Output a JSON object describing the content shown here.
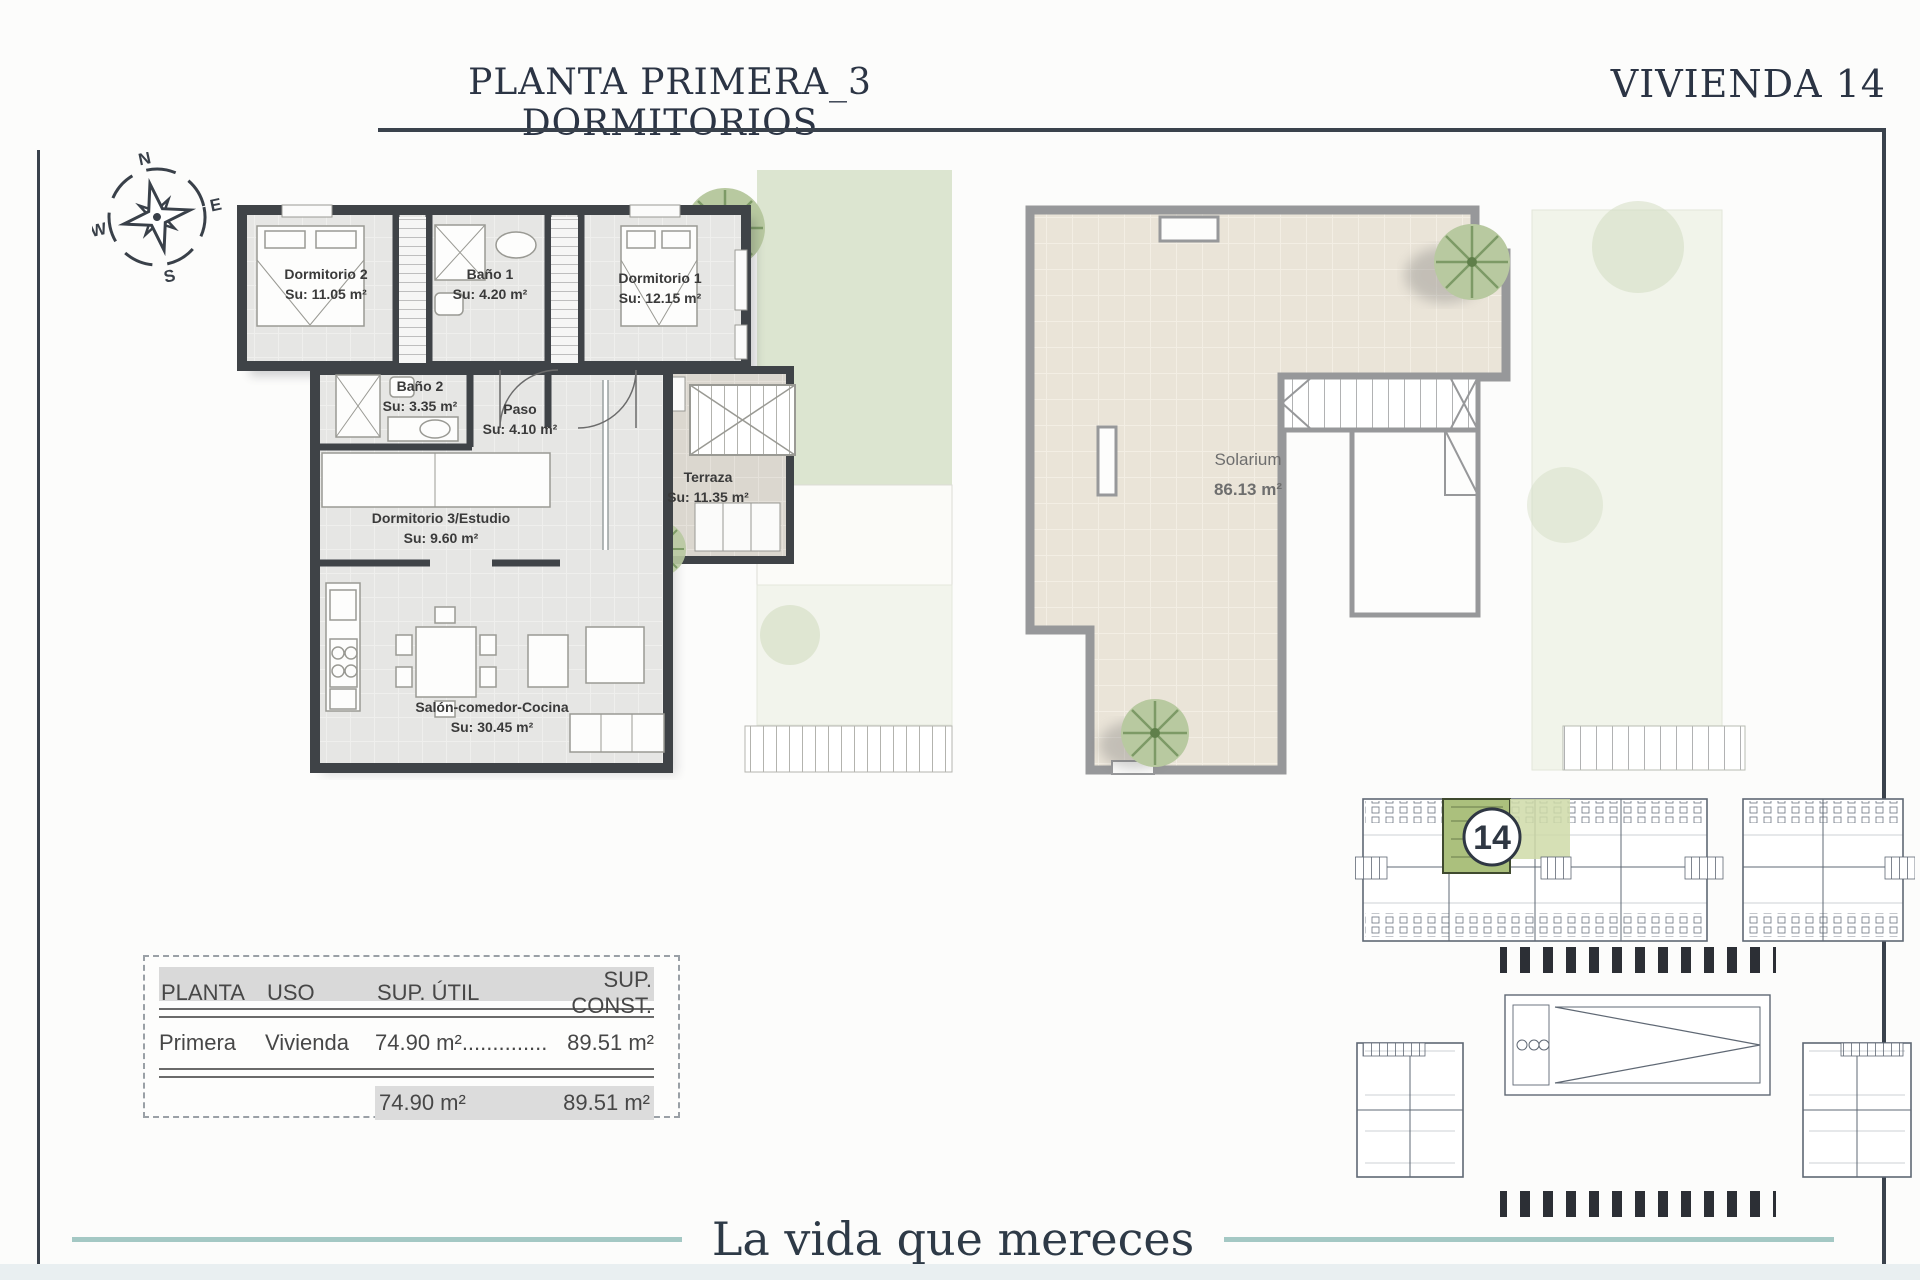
{
  "header": {
    "title": "PLANTA PRIMERA_3 DORMITORIOS",
    "unit_label": "VIVIENDA 14"
  },
  "compass": {
    "n": "N",
    "e": "E",
    "s": "S",
    "w": "W"
  },
  "floor_plan": {
    "rooms": [
      {
        "name": "Dormitorio 2",
        "area": "Su: 11.05 m²"
      },
      {
        "name": "Baño 1",
        "area": "Su: 4.20 m²"
      },
      {
        "name": "Dormitorio 1",
        "area": "Su: 12.15 m²"
      },
      {
        "name": "Baño 2",
        "area": "Su: 3.35 m²"
      },
      {
        "name": "Paso",
        "area": "Su: 4.10 m²"
      },
      {
        "name": "Terraza",
        "area": "Su: 11.35 m²"
      },
      {
        "name": "Dormitorio 3/Estudio",
        "area": "Su: 9.60 m²"
      },
      {
        "name": "Salón-comedor-Cocina",
        "area": "Su: 30.45 m²"
      }
    ]
  },
  "solarium_plan": {
    "name": "Solarium",
    "area": "86.13 m²"
  },
  "site_plan": {
    "unit_number": "14"
  },
  "areas_table": {
    "headers": [
      "PLANTA",
      "USO",
      "SUP. ÚTIL",
      "SUP. CONST."
    ],
    "rows": [
      {
        "planta": "Primera",
        "uso": "Vivienda",
        "sup_util": "74.90 m²..............",
        "sup_const": "89.51 m²"
      }
    ],
    "totals": {
      "sup_util": "74.90 m²",
      "sup_const": "89.51 m²"
    }
  },
  "footer": {
    "tagline": "La vida que mereces"
  },
  "colors": {
    "accent_teal": "#a4c8c4",
    "heading_navy": "#2b3444",
    "wall_dark": "#3f4347",
    "solarium_wall_gray": "#97989a",
    "garden_green": "#dce5d0",
    "site_highlight_green": "#abc07d"
  }
}
